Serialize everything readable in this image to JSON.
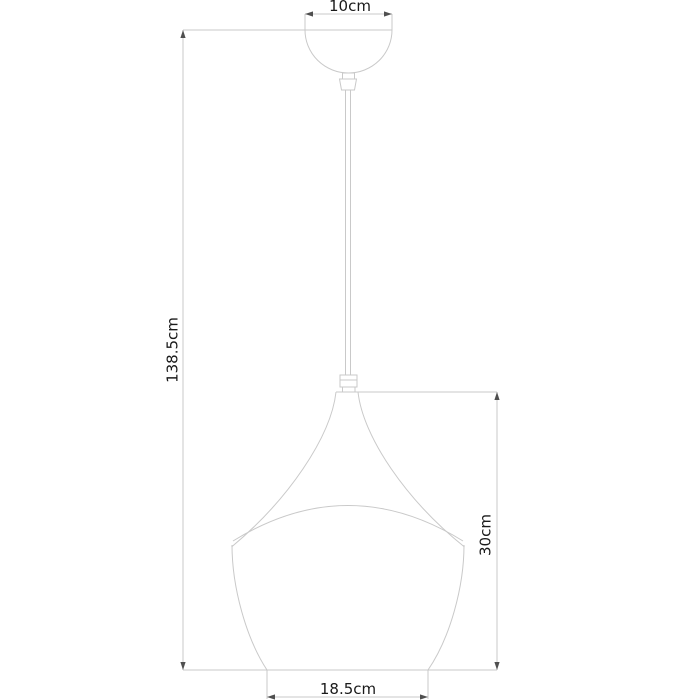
{
  "page": {
    "background": "#ffffff"
  },
  "diagram": {
    "type": "pendant-lamp-dimension-drawing",
    "labels": {
      "canopy_width": "10cm",
      "overall_height": "138.5cm",
      "shade_height": "30cm",
      "shade_bottom_width": "18.5cm"
    },
    "colors": {
      "outline": "#c9c9c9",
      "dimension_arrow": "#4f4f4f",
      "label_text": "#1a1a1a",
      "background": "#ffffff"
    }
  }
}
